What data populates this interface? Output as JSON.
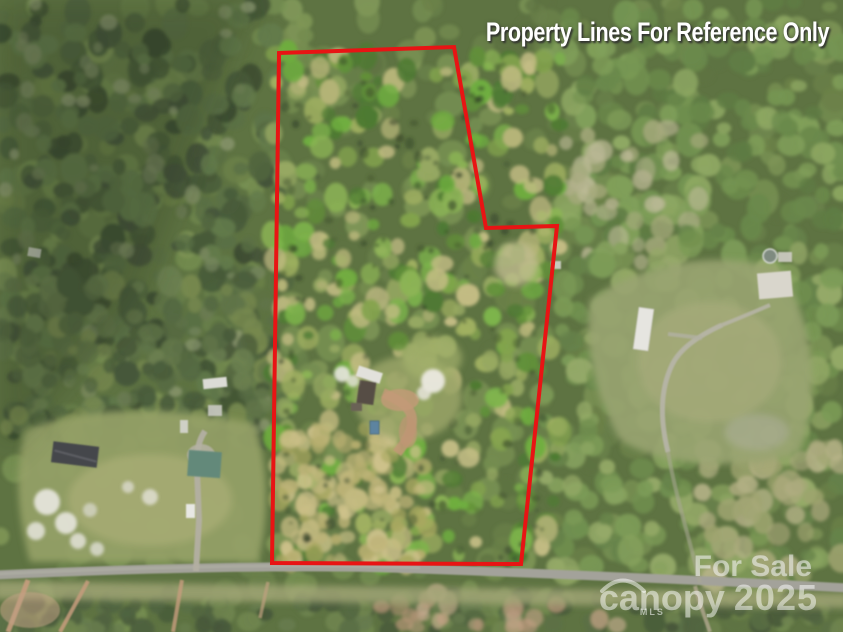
{
  "disclaimer": {
    "text": "Property Lines For Reference Only",
    "color": "#ffffff"
  },
  "property_boundary": {
    "color": "#e81414",
    "points": "279,53 454,47 486,228 557,226 521,564 272,563"
  },
  "watermark": {
    "for_sale": "For Sale",
    "brand": "canopy",
    "year": "2025",
    "mls": "MLS",
    "color": "rgba(255,255,255,0.5)"
  }
}
